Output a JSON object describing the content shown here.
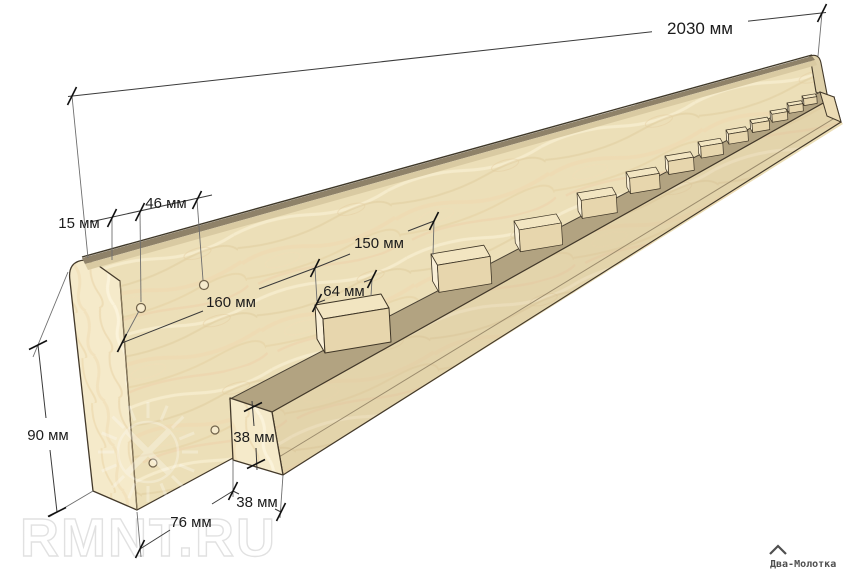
{
  "diagram": {
    "type": "woodworking assembly drawing",
    "subject": "long wooden board with bottom rail and evenly spaced spacer blocks",
    "unit": "мм"
  },
  "dimensions": {
    "total_length": "2030 мм",
    "top_edge_offset": "15 мм",
    "hole_end_offset": "46 мм",
    "hole_spacing": "160 мм",
    "block_spacing": "150 мм",
    "block_length": "64 мм",
    "board_height": "90 мм",
    "board_thickness": "76 мм",
    "rail_width": "38 мм",
    "rail_height": "38 мм"
  },
  "parts": {
    "spacer_block_count": 12,
    "visible_hole_count": 4
  },
  "branding": {
    "watermark": "RMNT.RU",
    "logo_text": "Два-Молотка"
  },
  "colors": {
    "background": "#ffffff",
    "wood_face": "#ecdfb8",
    "wood_end_grain": "#f5eaca",
    "rail_shadow_band": "#b2a381",
    "rail_front": "#e2d2a9",
    "outline": "#43392a",
    "dimension_line": "#3a3a3a",
    "dimension_text": "#1c1c1c"
  }
}
